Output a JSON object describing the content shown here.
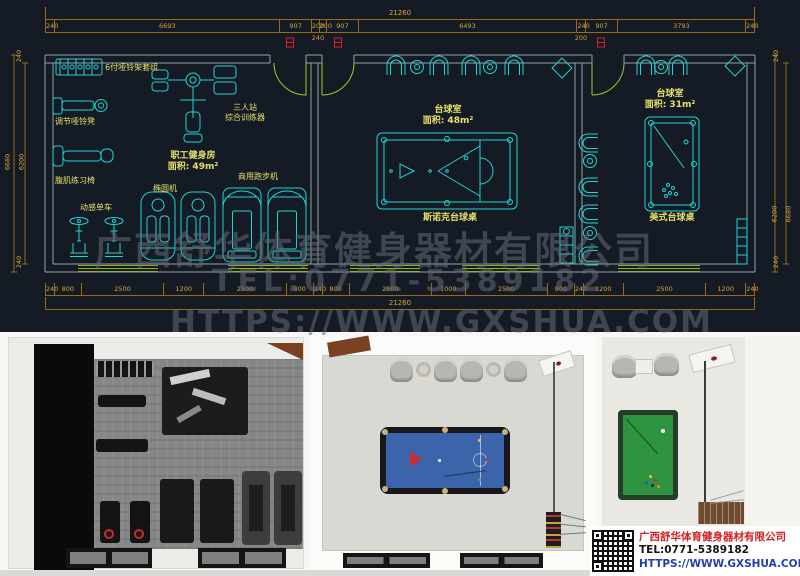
{
  "cad": {
    "top_total": "21260",
    "top_dims": [
      "240",
      "6693",
      "907",
      "200",
      "200",
      "907",
      "6493",
      "240",
      "907",
      "3793",
      "240"
    ],
    "top_sub_left": "240",
    "top_sub_right": "200",
    "bottom_dims": [
      "240",
      "800",
      "2500",
      "1200",
      "2500",
      "800",
      "240",
      "800",
      "2500",
      "1000",
      "2500",
      "800",
      "240",
      "1200",
      "2500",
      "1200",
      "240"
    ],
    "bottom_total": "21260",
    "left_dims": {
      "top": "240",
      "outer": "6680",
      "inner": "6200",
      "bottom": "240"
    },
    "right_dims": {
      "top": "240",
      "inner": "6200",
      "outer": "6680",
      "bottom": "240"
    },
    "rooms": {
      "gym": {
        "line1": "职工健身房",
        "line2": "面积: 49m²"
      },
      "bil1": {
        "line1": "台球室",
        "line2": "面积: 48m²",
        "table": "斯诺克台球桌"
      },
      "bil2": {
        "line1": "台球室",
        "line2": "面积: 31m²",
        "table": "美式台球桌"
      }
    },
    "equipment": {
      "rack": "6付哑铃架套组",
      "bench_adjust": "调节哑铃凳",
      "bench_ab": "腹肌练习椅",
      "bike": "动感单车",
      "elliptical": "椭圆机",
      "treadmill": "商用跑步机",
      "trainer_line1": "三人站",
      "trainer_line2": "综合训练器"
    },
    "colors": {
      "line_cyan": "#1fd6d6",
      "dim_orange": "#d9a33b",
      "label_yellow": "#e6e06d",
      "door_green": "#a9c42a",
      "marker_red": "#d22626",
      "background": "#141b24"
    }
  },
  "watermark": {
    "line1": "广西舒华体育健身器材有限公司",
    "line2": "TEL:0771-5389182",
    "line3": "HTTPS://WWW.GXSHUA.COM"
  },
  "info": {
    "company": "广西舒华体育健身器材有限公司",
    "tel": "TEL:0771-5389182",
    "url": "HTTPS://WWW.GXSHUA.COM"
  }
}
